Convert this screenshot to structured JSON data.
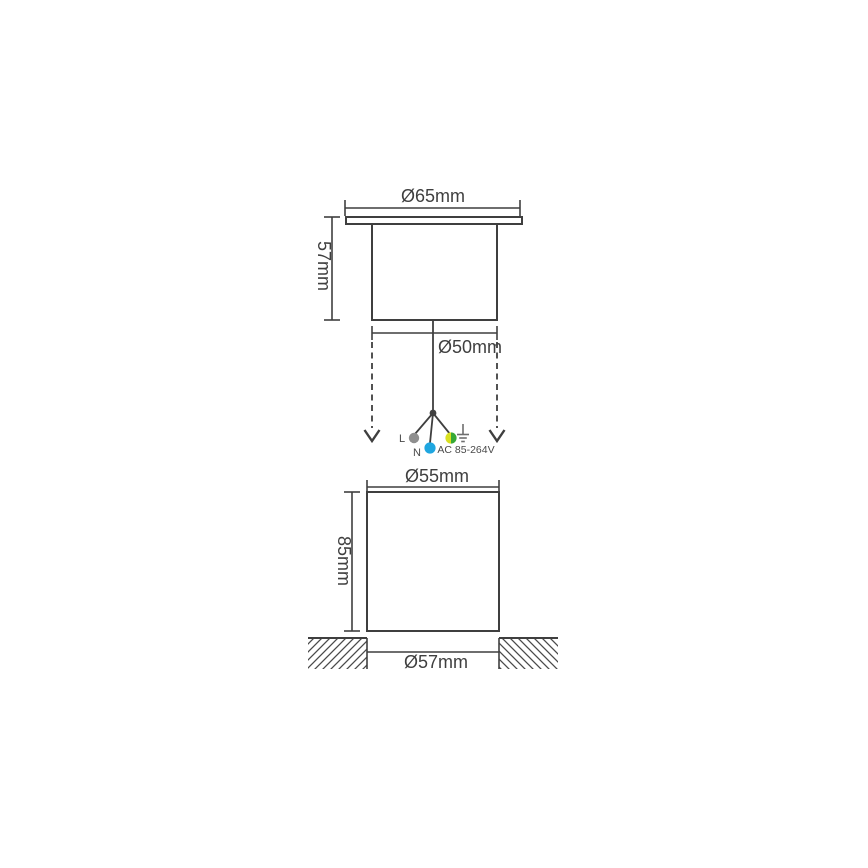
{
  "diagram": {
    "line_color": "#3f3f3f",
    "text_color": "#3f3f3f",
    "fixture_front_view": {
      "flange_diameter_label": "Ø65mm",
      "recess_height_label": "57mm",
      "body_diameter_label": "Ø50mm"
    },
    "wiring": {
      "live_label": "L",
      "neutral_label": "N",
      "rating_label": "AC 85-264V",
      "live_wire_color": "#8f8f8f",
      "neutral_wire_color": "#1fa6e0",
      "earth_wire_yellow": "#d9e021",
      "earth_wire_green": "#37a935",
      "ground_icon_color": "#6e6e6e"
    },
    "mounting_sleeve_view": {
      "outer_diameter_label": "Ø55mm",
      "depth_label": "85mm",
      "cutout_diameter_label": "Ø57mm"
    }
  }
}
